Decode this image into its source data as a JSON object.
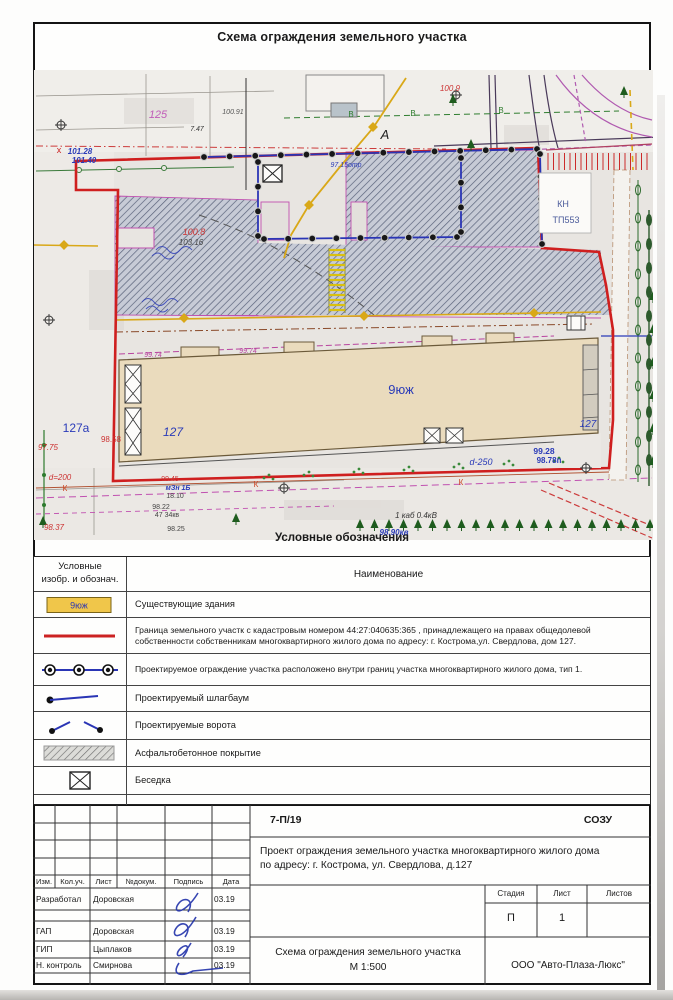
{
  "page": {
    "top_title": "Схема ограждения земельного участка"
  },
  "map": {
    "labels": [
      {
        "t": "125",
        "x": 124,
        "y": 48,
        "c": "#c05cb8",
        "s": 11,
        "i": 1
      },
      {
        "t": "100.91",
        "x": 199,
        "y": 44,
        "c": "#555555",
        "s": 7,
        "i": 1
      },
      {
        "t": "7.47",
        "x": 163,
        "y": 61,
        "c": "#333333",
        "s": 7,
        "i": 1
      },
      {
        "t": "101.28",
        "x": 46,
        "y": 84,
        "c": "#2a3bb8",
        "s": 8,
        "i": 1,
        "b": 1
      },
      {
        "t": "101.40",
        "x": 50,
        "y": 93,
        "c": "#2a3bb8",
        "s": 8,
        "i": 1,
        "b": 1
      },
      {
        "t": "х",
        "x": 25,
        "y": 83,
        "c": "#cc2222",
        "s": 9
      },
      {
        "t": "А",
        "x": 351,
        "y": 69,
        "c": "#222222",
        "s": 13,
        "i": 1
      },
      {
        "t": "100.9",
        "x": 416,
        "y": 21,
        "c": "#cc3333",
        "s": 8,
        "i": 1
      },
      {
        "t": "В",
        "x": 317,
        "y": 47,
        "c": "#2f7d2f",
        "s": 8
      },
      {
        "t": "В",
        "x": 379,
        "y": 46,
        "c": "#2f7d2f",
        "s": 8
      },
      {
        "t": "В",
        "x": 467,
        "y": 43,
        "c": "#2f7d2f",
        "s": 8
      },
      {
        "t": "97.15отр",
        "x": 312,
        "y": 97,
        "c": "#2a3bb8",
        "s": 7,
        "i": 1
      },
      {
        "t": "КН",
        "x": 529,
        "y": 137,
        "c": "#4a5a9a",
        "s": 9
      },
      {
        "t": "ТП553",
        "x": 532,
        "y": 153,
        "c": "#4a5a9a",
        "s": 9
      },
      {
        "t": "100.8",
        "x": 160,
        "y": 165,
        "c": "#cc3333",
        "s": 9,
        "i": 1
      },
      {
        "t": "103.16",
        "x": 157,
        "y": 175,
        "c": "#444444",
        "s": 8,
        "i": 1
      },
      {
        "t": "99.74",
        "x": 119,
        "y": 287,
        "c": "#b8449f",
        "s": 7,
        "i": 1
      },
      {
        "t": "99.74",
        "x": 214,
        "y": 283,
        "c": "#b8449f",
        "s": 7,
        "i": 1
      },
      {
        "t": "9юж",
        "x": 367,
        "y": 324,
        "c": "#2a3bb8",
        "s": 13
      },
      {
        "t": "127",
        "x": 139,
        "y": 366,
        "c": "#2a3bb8",
        "s": 12,
        "i": 1
      },
      {
        "t": "127",
        "x": 554,
        "y": 357,
        "c": "#2a3bb8",
        "s": 10,
        "i": 1
      },
      {
        "t": "127а",
        "x": 42,
        "y": 362,
        "c": "#2a3bb8",
        "s": 12
      },
      {
        "t": "98.58",
        "x": 77,
        "y": 372,
        "c": "#cc3333",
        "s": 8
      },
      {
        "t": "97.75",
        "x": 14,
        "y": 380,
        "c": "#cc3333",
        "s": 8,
        "i": 1
      },
      {
        "t": "d=200",
        "x": 26,
        "y": 410,
        "c": "#cc3333",
        "s": 8,
        "i": 1
      },
      {
        "t": "К",
        "x": 31,
        "y": 421,
        "c": "#cc4422",
        "s": 8
      },
      {
        "t": "К",
        "x": 222,
        "y": 417,
        "c": "#cc4422",
        "s": 8
      },
      {
        "t": "К",
        "x": 427,
        "y": 415,
        "c": "#cc4422",
        "s": 8
      },
      {
        "t": "99.45",
        "x": 136,
        "y": 411,
        "c": "#cc3333",
        "s": 7
      },
      {
        "t": "мЗн 1Б",
        "x": 144,
        "y": 420,
        "c": "#2a3bb8",
        "s": 7,
        "b": 1,
        "i": 1
      },
      {
        "t": "18.10",
        "x": 141,
        "y": 428,
        "c": "#444444",
        "s": 7
      },
      {
        "t": "98.22",
        "x": 127,
        "y": 439,
        "c": "#444444",
        "s": 7
      },
      {
        "t": "47 34кв",
        "x": 133,
        "y": 447,
        "c": "#444444",
        "s": 7
      },
      {
        "t": "98.25",
        "x": 142,
        "y": 461,
        "c": "#444444",
        "s": 7
      },
      {
        "t": "98.37",
        "x": 20,
        "y": 460,
        "c": "#cc3333",
        "s": 8,
        "i": 1
      },
      {
        "t": "99.28",
        "x": 510,
        "y": 384,
        "c": "#2a3bb8",
        "s": 8.5,
        "b": 1
      },
      {
        "t": "98.78п",
        "x": 515,
        "y": 393,
        "c": "#2a3bb8",
        "s": 8,
        "b": 1
      },
      {
        "t": "d-250",
        "x": 447,
        "y": 395,
        "c": "#2a3bb8",
        "s": 9,
        "i": 1
      },
      {
        "t": "1 каб 0.4кВ",
        "x": 382,
        "y": 448,
        "c": "#333333",
        "s": 8,
        "i": 1
      },
      {
        "t": "98.90кв",
        "x": 360,
        "y": 465,
        "c": "#2a3bb8",
        "s": 8,
        "i": 1,
        "b": 1
      }
    ]
  },
  "legend": {
    "title": "Условные обозначения",
    "col_symbol_header_l1": "Условные",
    "col_symbol_header_l2": "изобр. и обознач.",
    "col_name_header": "Наименование",
    "rows": [
      {
        "symbol": "existing-building",
        "symbol_label": "9юж",
        "text": "Существующие здания"
      },
      {
        "symbol": "site-boundary",
        "text": "Граница земельного участк с кадастровым номером 44:27:040635:365 , принадлежащего на правах общедолевой собственности собственникам многоквартирного жилого дома по адресу: г. Кострома,ул. Свердлова, дом 127."
      },
      {
        "symbol": "fence",
        "text": "Проектируемое ограждение участка расположено внутри границ участка многоквартирного жилого дома, тип 1."
      },
      {
        "symbol": "barrier",
        "text": "Проектируемый шлагбаум"
      },
      {
        "symbol": "gates",
        "text": "Проектируемые ворота"
      },
      {
        "symbol": "asphalt",
        "text": "Асфальтобетонное покрытие"
      },
      {
        "symbol": "gazebo",
        "text": "Беседка"
      }
    ]
  },
  "stamp": {
    "doc_number": "7-П/19",
    "org_code": "СОЗУ",
    "project_line1": "Проект  ограждения земельного участка  многоквартирного жилого дома",
    "project_line2": "по адресу: г. Кострома, ул. Свердлова, д.127",
    "col_izm": "Изм.",
    "col_koluch": "Кол.уч.",
    "col_list": "Лист",
    "col_ndokum": "№докум.",
    "col_podpis": "Подпись",
    "col_data": "Дата",
    "stage_label": "Стадия",
    "sheet_label": "Лист",
    "sheets_label": "Листов",
    "stage_value": "П",
    "sheet_value": "1",
    "sheets_value": "",
    "sheet_title_line1": "Схема ограждения земельного участка",
    "scale": "М 1:500",
    "company": "ООО \"Авто-Плаза-Люкс\"",
    "rows": [
      {
        "role": "Разработал",
        "name": "Доровская",
        "date": "03.19"
      },
      {
        "role": "",
        "name": "",
        "date": ""
      },
      {
        "role": "ГАП",
        "name": "Доровская",
        "date": "03.19"
      },
      {
        "role": "ГИП",
        "name": "Цыплаков",
        "date": "03.19"
      },
      {
        "role": "Н. контроль",
        "name": "Смирнова",
        "date": "03.19"
      },
      {
        "role": "",
        "name": "",
        "date": ""
      }
    ]
  },
  "colors": {
    "boundary_red": "#cc2222",
    "fence_blue": "#2a35b5",
    "hatch_line": "#59627a",
    "building_fill": "#eadbbd",
    "legend_building_fill": "#f0c64a"
  }
}
